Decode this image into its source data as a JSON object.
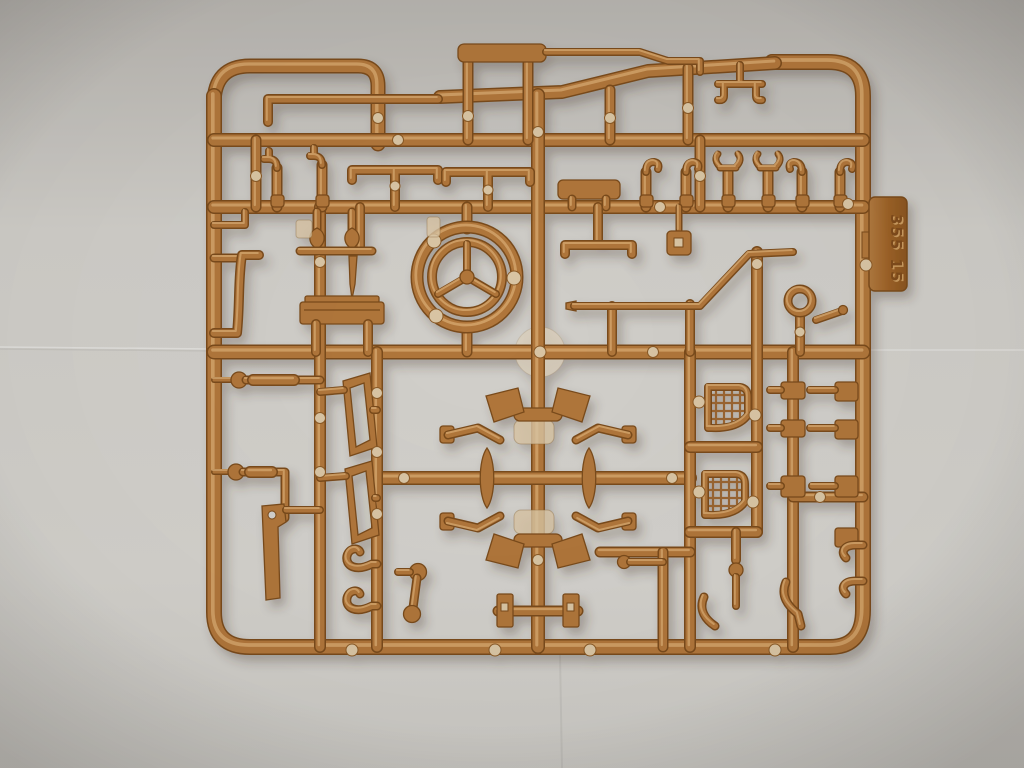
{
  "scene": {
    "subject": "Tan plastic injection-moulded sprue (model kit parts tree) photographed on a grey backdrop",
    "notable_parts": [
      "steering wheel",
      "radiator grilles",
      "leaf springs",
      "tie rods",
      "tow hooks",
      "gear levers",
      "windshield frames",
      "tool box",
      "fuel tank"
    ]
  },
  "tab": {
    "mold_number": "355 15"
  },
  "colors": {
    "background": "#d3d1cc",
    "background_edge": "#aeaba6",
    "plastic": "#b0763a",
    "plastic_highlight": "#d4a56c",
    "plastic_dark": "#7a4c1d",
    "gate_flash": "#d9c5a4",
    "tab_face": "#9c6228"
  }
}
